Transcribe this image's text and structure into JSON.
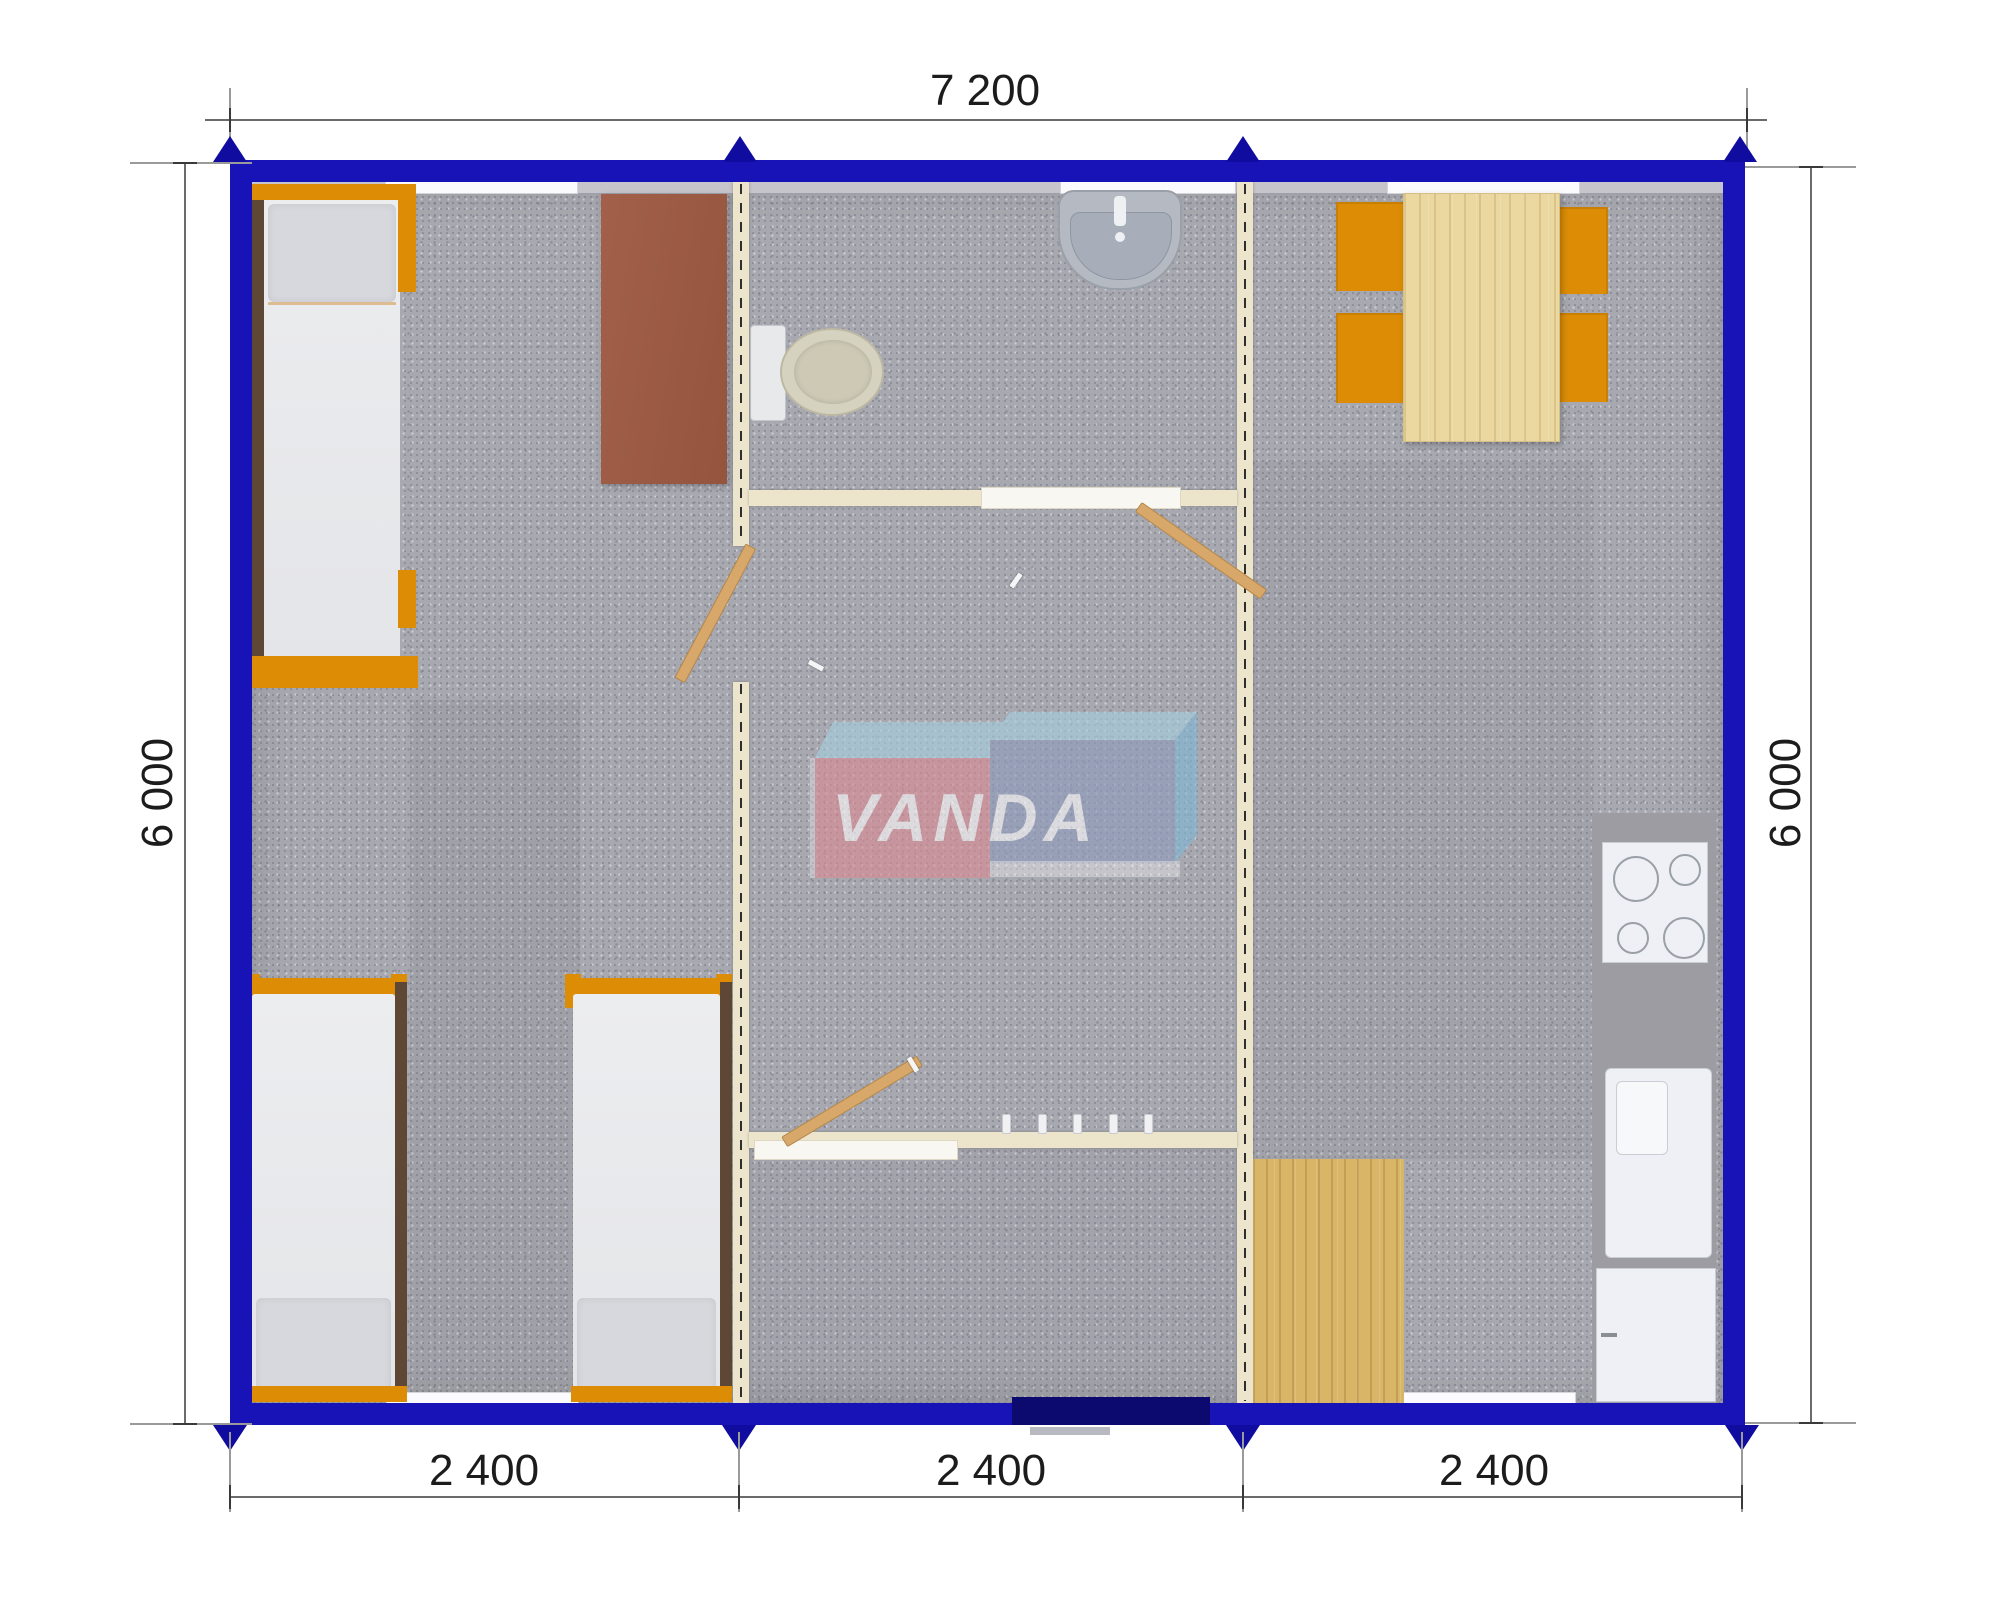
{
  "watermark": {
    "text": "VANDA"
  },
  "dimensions": {
    "top_width": "7 200",
    "left_height": "6 000",
    "right_height": "6 000",
    "bottom_segments": [
      "2 400",
      "2 400",
      "2 400"
    ]
  },
  "colors": {
    "exterior_wall_blue": "#1713b6",
    "entrance_door_navy": "#0c0a6e",
    "interior_wall_cream": "#ece5cc",
    "floor_carpet_grey": "#a8a8b0",
    "furniture_orange": "#dd8d05",
    "table_wood": "#ead8a0",
    "floor_mat_wood": "#d9b568",
    "desk_brown": "#9b5a42",
    "kitchen_counter_grey": "#9c9ca2",
    "dimension_text": "#1c1c1c",
    "logo_pink": "#d98a94",
    "logo_blue": "#8f9cbd",
    "logo_light_blue": "#a5cfe0"
  }
}
